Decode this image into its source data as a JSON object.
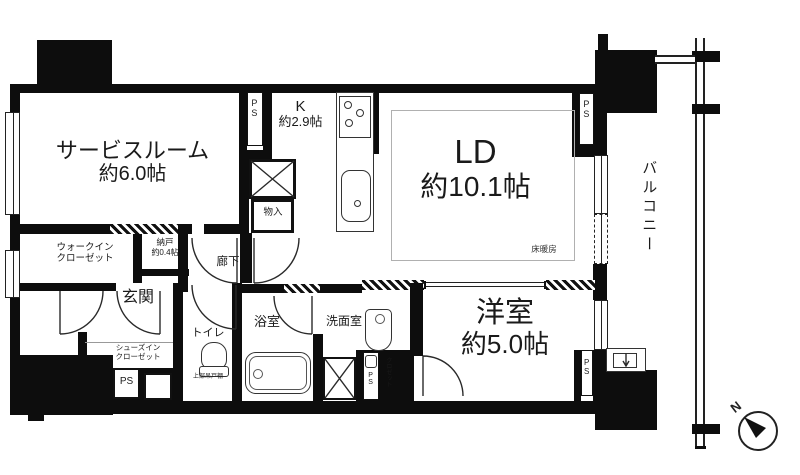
{
  "rooms": {
    "service_room": {
      "name": "サービスルーム",
      "size": "約6.0帖"
    },
    "kitchen": {
      "name": "K",
      "size": "約2.9帖"
    },
    "living_dining": {
      "name": "LD",
      "size": "約10.1帖"
    },
    "floor_heating": {
      "label": "床暖房"
    },
    "western_room": {
      "name": "洋室",
      "size": "約5.0帖"
    },
    "balcony": {
      "name": "バルコニー"
    },
    "entrance": {
      "name": "玄関"
    },
    "hallway": {
      "name": "廊下"
    },
    "toilet": {
      "name": "トイレ",
      "shelf_note": "上部吊戸棚"
    },
    "bathroom": {
      "name": "浴室"
    },
    "washroom": {
      "name": "洗面室"
    },
    "walk_in_closet": {
      "line1": "ウォークイン",
      "line2": "クローゼット"
    },
    "shoes_in_closet": {
      "line1": "シューズイン",
      "line2": "クローゼット"
    },
    "storage_nando": {
      "name": "納戸",
      "size": "約0.4帖"
    },
    "storage_monoire": {
      "name": "物入"
    },
    "closet_strip": {
      "name": "クロゼット"
    }
  },
  "labels": {
    "pipe_space": "PS",
    "north": "N"
  },
  "colors": {
    "wall": "#0d0d0d",
    "line": "#2a2a2a",
    "background": "#ffffff"
  }
}
